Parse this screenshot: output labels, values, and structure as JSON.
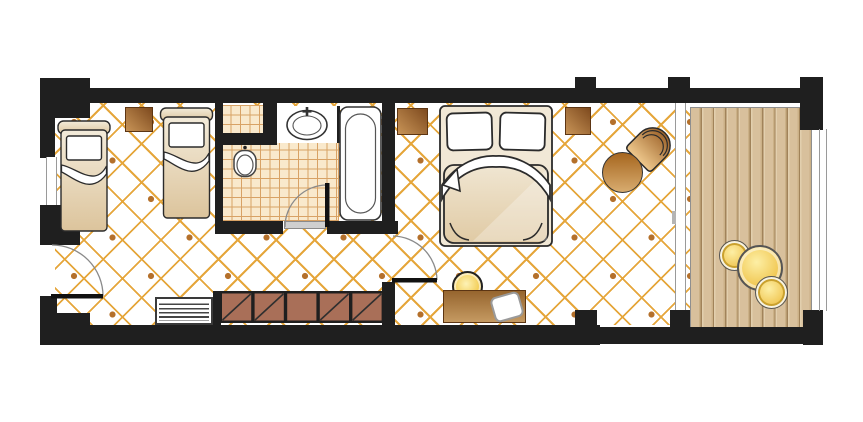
{
  "title": "Hotel guest room floor plan",
  "canvas": {
    "width": 863,
    "height": 422
  },
  "palette": {
    "wall": "#1f1f1f",
    "outline": "#2b2b2b",
    "floor_line": "#e5a63b",
    "floor_dot": "#b4702b",
    "tile_bg": "#f9e9cc",
    "tile_line": "#d8a265",
    "deck_light": "#d8c09c",
    "deck_dark": "#a1835a",
    "wood_dark": "#7e4a1e",
    "wood_light": "#c89457",
    "wardrobe": "#a96f58",
    "bed_beige": "#e8d7b4",
    "yellow": "#f3ce58",
    "glass": "#9a9a9a"
  },
  "areas": [
    "twin-bed-area",
    "bathroom",
    "double-bedroom",
    "sitting-corner",
    "balcony-deck"
  ],
  "furniture_icons": [
    "single-bed-icon",
    "single-bed-icon",
    "nightstand-icon",
    "luggage-rack-icon",
    "wardrobe-icon",
    "sink-icon",
    "toilet-icon",
    "bathtub-icon",
    "shower-shelf-icon",
    "double-bed-icon",
    "nightstand-icon",
    "nightstand-icon",
    "desk-icon",
    "stool-icon",
    "tv-icon",
    "armchair-icon",
    "side-table-icon",
    "balcony-table-icon",
    "balcony-chair-icon",
    "balcony-chair-icon",
    "entry-door-icon",
    "bathroom-door-icon",
    "bedroom-door-icon",
    "sliding-door-icon",
    "window-icon"
  ]
}
